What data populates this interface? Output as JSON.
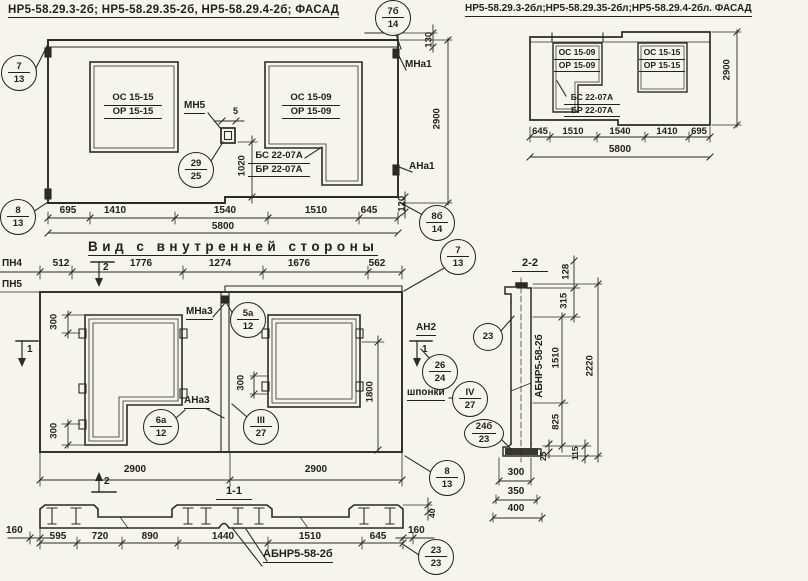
{
  "colors": {
    "ink": "#22211c",
    "paper": "#f5f4ef"
  },
  "fl": {
    "title": "НР5-58.29.3-2б; НР5-58.29.35-2б, НР5-58.29.4-2б; ФАСАД",
    "win_left": {
      "top": "ОС 15-15",
      "bot": "ОР 15-15"
    },
    "win_right": {
      "top": "ОС 15-09",
      "bot": "ОР 15-09"
    },
    "lintel": {
      "top": "БС 22-07А",
      "bot": "БР 22-07А"
    },
    "mn5": "МН5",
    "mna1": "МНа1",
    "ana1": "АНа1",
    "d5": "5",
    "d130": "130",
    "d1020": "1020",
    "d2900": "2900",
    "d120": "120",
    "dims": [
      "695",
      "1410",
      "1540",
      "1510",
      "645"
    ],
    "total": "5800",
    "b7": {
      "t": "7",
      "b": "13"
    },
    "b8": {
      "t": "8",
      "b": "13"
    },
    "b7b": {
      "t": "7б",
      "b": "14"
    },
    "b8b": {
      "t": "8б",
      "b": "14"
    },
    "b29": {
      "t": "29",
      "b": "25"
    }
  },
  "fr": {
    "title": "НР5-58.29.3-2бл;НР5-58.29.35-2бл;НР5-58.29.4-2бл. ФАСАД",
    "win_left": {
      "top": "ОС 15-09",
      "bot": "ОР 15-09"
    },
    "win_right": {
      "top": "ОС 15-15",
      "bot": "ОР 15-15"
    },
    "lintel": {
      "top": "БС 22-07А",
      "bot": "БР 22-07А"
    },
    "d2900": "2900",
    "dims": [
      "645",
      "1510",
      "1540",
      "1410",
      "695"
    ],
    "total": "5800"
  },
  "iv": {
    "title": "Вид с внутренней стороны",
    "pn4": "ПН4",
    "pn5": "ПН5",
    "dims_top": [
      "512",
      "1776",
      "1274",
      "1676",
      "562"
    ],
    "mna3": "МНа3",
    "ana3": "АНа3",
    "an2": "АН2",
    "shponki": "шпонки",
    "d300": "300",
    "d1800": "1800",
    "d2900": "2900",
    "mark1": "1",
    "mark2": "2",
    "b5a": {
      "t": "5а",
      "b": "12"
    },
    "b6a": {
      "t": "6а",
      "b": "12"
    },
    "b3": {
      "t": "III",
      "b": "27"
    },
    "b26": {
      "t": "26",
      "b": "24"
    },
    "b4": {
      "t": "IV",
      "b": "27"
    },
    "b7": {
      "t": "7",
      "b": "13"
    },
    "b8": {
      "t": "8",
      "b": "13"
    }
  },
  "s11": {
    "title": "1-1",
    "label": "АБНР5-58-2б",
    "dims": [
      "595",
      "720",
      "890",
      "1440",
      "1510",
      "645"
    ],
    "d160": "160",
    "d40": "40",
    "b23": {
      "t": "23",
      "b": "23"
    }
  },
  "s22": {
    "title": "2-2",
    "label": "АБНР5-58-2б",
    "d128": "128",
    "d315": "315",
    "d1510": "1510",
    "d825": "825",
    "d2220": "2220",
    "d25": "25",
    "d115": "115",
    "dims_bottom": [
      "300",
      "350",
      "400"
    ],
    "b23": "23",
    "b24": {
      "t": "24б",
      "b": "23"
    }
  }
}
